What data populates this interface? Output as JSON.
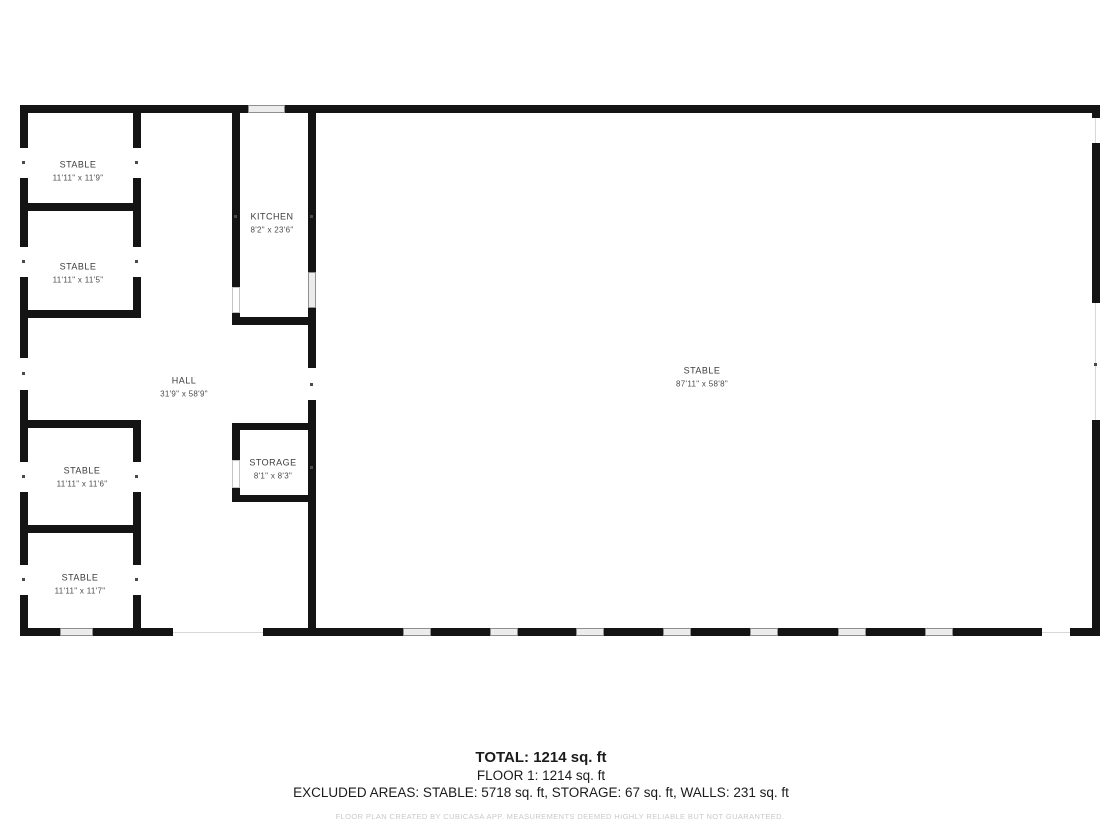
{
  "floorplan": {
    "rooms": [
      {
        "name": "STABLE",
        "dims": "11'11\" x 11'9\""
      },
      {
        "name": "STABLE",
        "dims": "11'11\" x 11'5\""
      },
      {
        "name": "KITCHEN",
        "dims": "8'2\" x 23'6\""
      },
      {
        "name": "HALL",
        "dims": "31'9\" x 58'9\""
      },
      {
        "name": "STORAGE",
        "dims": "8'1\" x 8'3\""
      },
      {
        "name": "STABLE",
        "dims": "11'11\" x 11'6\""
      },
      {
        "name": "STABLE",
        "dims": "11'11\" x 11'7\""
      },
      {
        "name": "STABLE",
        "dims": "87'11\" x 58'8\""
      }
    ]
  },
  "summary": {
    "total": "TOTAL: 1214 sq. ft",
    "floor": "FLOOR 1: 1214 sq. ft",
    "excluded": "EXCLUDED AREAS: STABLE: 5718 sq. ft, STORAGE: 67 sq. ft, WALLS: 231 sq. ft",
    "disclaimer": "FLOOR PLAN CREATED BY CUBICASA APP. MEASUREMENTS DEEMED HIGHLY RELIABLE BUT NOT GUARANTEED."
  },
  "colors": {
    "wall": "#141414",
    "window_fill": "#ececec",
    "window_border": "#8f8f8f",
    "label_text": "#3d3d3d",
    "disclaimer_text": "#c9c9c9"
  }
}
